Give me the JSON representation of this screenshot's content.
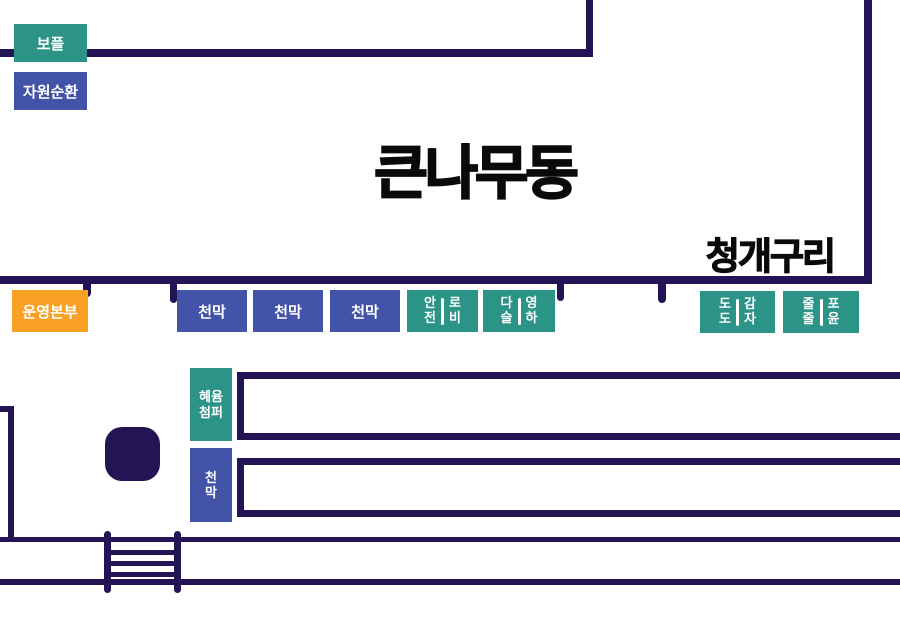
{
  "colors": {
    "navy": "#241355",
    "teal": "#2b9487",
    "blue": "#4253a8",
    "orange": "#f9a125",
    "ink": "#0a0a0a"
  },
  "zone": {
    "title": "큰나무동",
    "neighbor_label": "청개구리"
  },
  "booths": {
    "bople": {
      "label": "보플"
    },
    "recycle": {
      "label": "자원순환"
    },
    "hq": {
      "label": "운영본부"
    },
    "tent1": {
      "label": "천막"
    },
    "tent2": {
      "label": "천막"
    },
    "tent3": {
      "label": "천막"
    },
    "pair_safety_lobby": {
      "left": [
        "안",
        "전"
      ],
      "right": [
        "로",
        "비"
      ]
    },
    "pair_daseul_yeongha": {
      "left": [
        "다",
        "슬"
      ],
      "right": [
        "영",
        "하"
      ]
    },
    "pair_dodo_gamja": {
      "left": [
        "도",
        "도"
      ],
      "right": [
        "감",
        "자"
      ]
    },
    "pair_juljul_poyun": {
      "left": [
        "줄",
        "줄"
      ],
      "right": [
        "포",
        "윤"
      ]
    },
    "hyeyum": {
      "lines": [
        "혜윰",
        "첨퍼"
      ]
    },
    "tent_vertical": {
      "lines": [
        "천",
        "막"
      ]
    }
  }
}
